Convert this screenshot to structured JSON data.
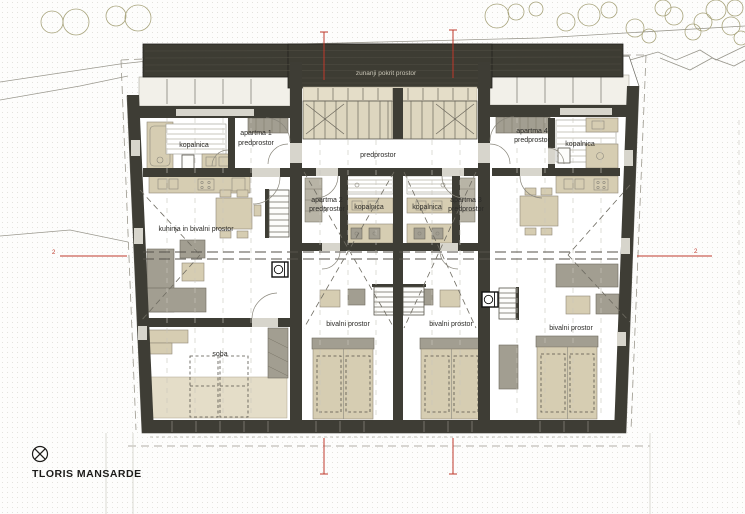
{
  "page": {
    "title": "TLORIS MANSARDE"
  },
  "plan": {
    "canopy_label": "zunanji pokrit prostor",
    "hall_label": "predprostor",
    "apartments": {
      "apt1": {
        "name": "apartma 1",
        "vestibule": "predprostor",
        "bath": "kopalnica",
        "kitchen_living": "kuhinja in bivalni prostor",
        "room": "soba"
      },
      "apt2": {
        "name": "apartma 2",
        "vestibule": "predprostor",
        "bath": "kopalnica",
        "living": "bivalni prostor"
      },
      "apt3": {
        "name": "apartma 3",
        "vestibule": "predprostor",
        "bath": "kopalnica",
        "living": "bivalni prostor"
      },
      "apt4": {
        "name": "apartma 4",
        "vestibule": "predprostor",
        "bath": "kopalnica",
        "living": "bivalni prostor"
      }
    },
    "section_markers": {
      "left": "2",
      "right": "2"
    }
  },
  "colors": {
    "wall": "#3e3d35",
    "roof": "#3d3c33",
    "furniture_beige": "#d6cdb2",
    "furniture_gray": "#a29e91",
    "section_red": "#c0392b",
    "paper": "#ffffff"
  }
}
